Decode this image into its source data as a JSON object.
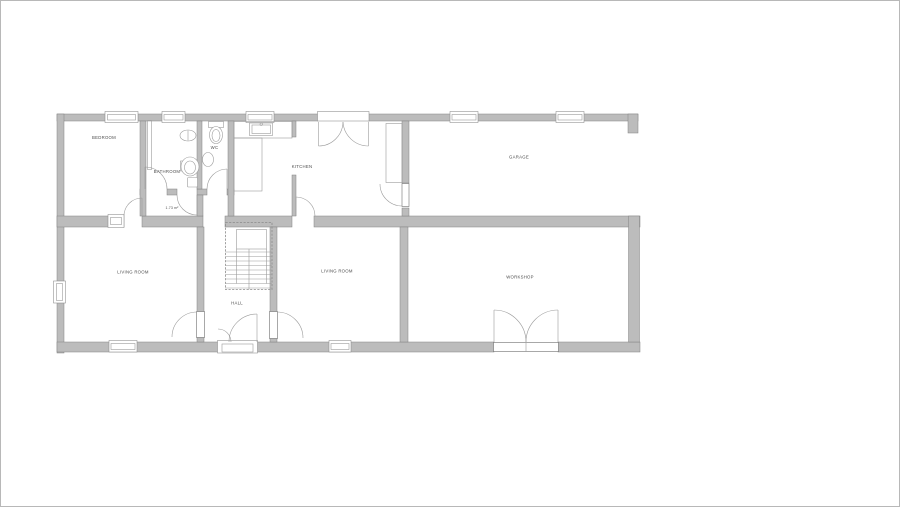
{
  "palette": {
    "wall_fill": "#bcbcbc",
    "wall_stroke": "#828282",
    "symbol_line": "#9b9b9b",
    "text": "#4d4d4d",
    "background": "#ffffff",
    "frame_border": "#b8b8b8"
  },
  "rooms": {
    "bedroom": {
      "label": "BEDROOM"
    },
    "bathroom": {
      "label": "BATHROOM"
    },
    "wc": {
      "label": "WC"
    },
    "kitchen": {
      "label": "KITCHEN"
    },
    "garage": {
      "label": "GARAGE"
    },
    "living_room_left": {
      "label": "LIVING ROOM"
    },
    "living_room_right": {
      "label": "LIVING ROOM"
    },
    "workshop": {
      "label": "WORKSHOP"
    },
    "hall": {
      "label": "HALL"
    },
    "closet": {
      "label": "1.73 m²"
    }
  }
}
